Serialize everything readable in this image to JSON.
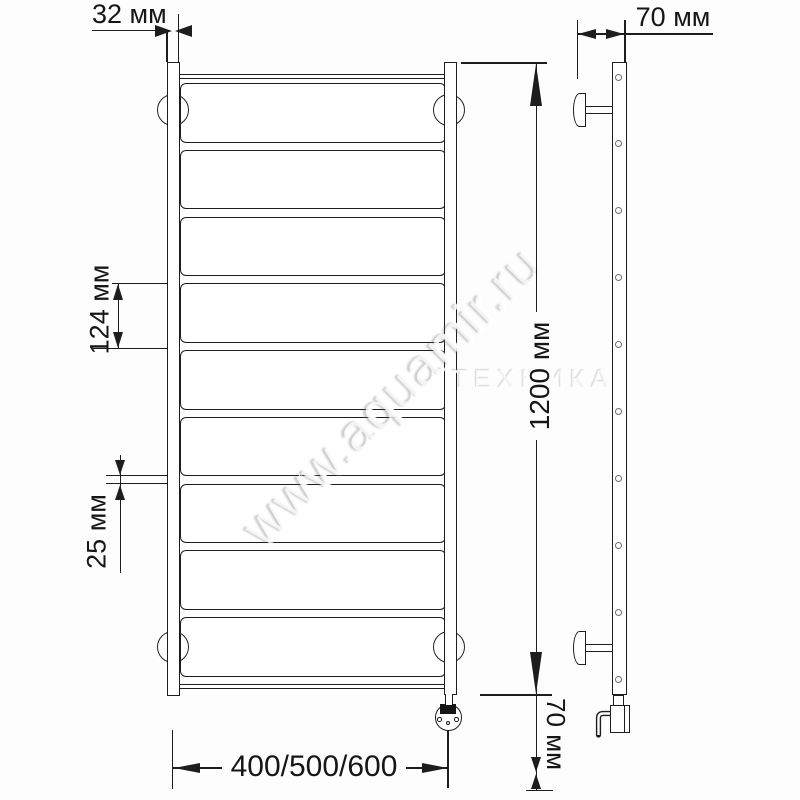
{
  "page": {
    "background_color": "#fdfdfd",
    "line_color": "#1d1d1d"
  },
  "watermark": {
    "primary": "www.aquamir.ru",
    "secondary": "ТЕХНИКА"
  },
  "views": {
    "front": {
      "rung_count": 9,
      "mount_bracket_count": 4,
      "has_electric_element": true
    },
    "side": {
      "hole_count": 10,
      "wall_bracket_count": 2,
      "has_power_hook": true
    }
  },
  "dimensions": {
    "rail_width": {
      "label": "32 мм",
      "value_mm": 32
    },
    "wall_offset": {
      "label": "70 мм",
      "value_mm": 70
    },
    "rung_pitch": {
      "label": "124 мм",
      "value_mm": 124
    },
    "rung_gap": {
      "label": "25 мм",
      "value_mm": 25
    },
    "overall_height": {
      "label": "1200 мм",
      "value_mm": 1200
    },
    "bottom_offset": {
      "label": "70 мм",
      "value_mm": 70
    },
    "width_options": {
      "label": "400/500/600",
      "values_mm": [
        400,
        500,
        600
      ]
    }
  }
}
